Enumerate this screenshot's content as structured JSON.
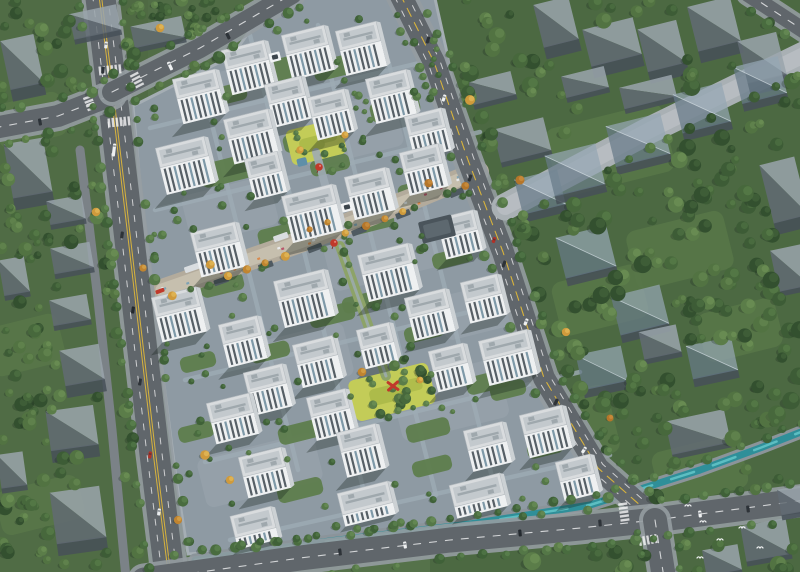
{
  "scene": {
    "description": "aerial-architectural-render-residential-masterplan",
    "canvas": {
      "width": 800,
      "height": 572
    },
    "palette": {
      "base_green": "#55724a",
      "left_tint": "#4d6842",
      "right_tint": "#43603a",
      "clearing": "#587748",
      "site_paving": "#8e9aa3",
      "site_paving_light": "#9aa6ae",
      "path": "#9eabb4",
      "courtyard": "#5e7d4d",
      "play_lawn": "#c3cc58",
      "play_lawn_dark": "#a8b647",
      "street_paving": "#b3ab9c",
      "street_paving_light": "#c6bfae",
      "sidewalk": "#959ca1",
      "asphalt": "#60666b",
      "asphalt_minor": "#7b8287",
      "lane_white": "#e8e9ea",
      "lane_yellow": "#d8b33c",
      "mall_paving": "#a9b0b4",
      "mall_paving_light": "#b8bec2",
      "canal_bank": "#8b949a",
      "water": "#2f8f99",
      "water_light": "#62c3c6",
      "roof_light": "#d9dcde",
      "roof_mid": "#c3c9cd",
      "roof_dark": "#9fa8ad",
      "facade": "#eef0f1",
      "facade_side": "#ccd1d4",
      "window_dark": "#565f66",
      "window_blue": "#7e99a8",
      "shadow": "rgba(22,32,28,0.33)",
      "ghost_light": "rgba(154,164,171,0.85)",
      "ghost_dark": "rgba(97,107,115,0.85)",
      "ghost_front": "rgba(70,80,88,0.85)",
      "glass_light": "rgba(148,166,179,0.72)",
      "glass_dark": "rgba(103,122,136,0.72)",
      "accent_red": "#c0392b",
      "shop_roof_dark": "#4f5a61",
      "canopy_white": "#d9dde0",
      "clubhouse": "#4a545b",
      "verge_green": "#7fb04c",
      "bird_white": "#f2f4f4"
    },
    "tree_palettes": {
      "forest": {
        "base": [
          "#33502f",
          "#3d5c36",
          "#47683c",
          "#527342",
          "#5b7d49"
        ],
        "hi": [
          "#4a6a40",
          "#557a48",
          "#60854e",
          "#6b9055",
          "#76995c"
        ]
      },
      "street": {
        "base": [
          "#3f6138",
          "#496c3f",
          "#547747"
        ],
        "hi": [
          "#5b8350",
          "#668e57",
          "#71985e"
        ]
      },
      "autumn": {
        "base": [
          "#c08430",
          "#cf9a3c",
          "#b5762a"
        ],
        "hi": [
          "#e2b659",
          "#edc968",
          "#d89c49"
        ]
      }
    }
  },
  "site": {
    "outline": [
      [
        133,
        106
      ],
      [
        232,
        56
      ],
      [
        276,
        -6
      ],
      [
        434,
        -6
      ],
      [
        446,
        48
      ],
      [
        466,
        158
      ],
      [
        498,
        252
      ],
      [
        538,
        385
      ],
      [
        592,
        472
      ],
      [
        612,
        502
      ],
      [
        520,
        512
      ],
      [
        380,
        536
      ],
      [
        240,
        550
      ],
      [
        188,
        554
      ],
      [
        176,
        478
      ],
      [
        157,
        330
      ],
      [
        141,
        195
      ]
    ],
    "paving_patches": [
      [
        250,
        90,
        90,
        50
      ],
      [
        350,
        130,
        100,
        55
      ],
      [
        230,
        210,
        90,
        50
      ],
      [
        380,
        250,
        110,
        60
      ],
      [
        300,
        360,
        100,
        55
      ],
      [
        450,
        400,
        110,
        60
      ],
      [
        260,
        470,
        120,
        50
      ],
      [
        480,
        310,
        80,
        45
      ]
    ]
  },
  "roads": [
    {
      "name": "road-main-left",
      "pts": [
        [
          100,
          -6
        ],
        [
          112,
          92
        ],
        [
          126,
          210
        ],
        [
          140,
          330
        ],
        [
          154,
          450
        ],
        [
          170,
          578
        ]
      ],
      "w": 30,
      "center": "yellow-double",
      "lanes": [
        -7.5,
        7.5
      ]
    },
    {
      "name": "road-left-branch",
      "pts": [
        [
          -6,
          128
        ],
        [
          58,
          116
        ],
        [
          112,
          95
        ]
      ],
      "w": 22,
      "center": "white-dash",
      "lanes": []
    },
    {
      "name": "road-top-arm",
      "pts": [
        [
          112,
          92
        ],
        [
          200,
          48
        ],
        [
          292,
          -6
        ]
      ],
      "w": 20,
      "center": "white-dash",
      "lanes": []
    },
    {
      "name": "road-right",
      "pts": [
        [
          400,
          -6
        ],
        [
          434,
          62
        ],
        [
          468,
          160
        ],
        [
          503,
          252
        ],
        [
          544,
          378
        ],
        [
          598,
          468
        ],
        [
          650,
          514
        ]
      ],
      "w": 22,
      "center": "yellow-dash",
      "lanes": [
        -6,
        6
      ]
    },
    {
      "name": "road-bottom",
      "pts": [
        [
          144,
          580
        ],
        [
          300,
          558
        ],
        [
          450,
          540
        ],
        [
          580,
          528
        ],
        [
          655,
          520
        ],
        [
          806,
          500
        ]
      ],
      "w": 25,
      "center": "white-dash",
      "lanes": []
    },
    {
      "name": "road-bottom-branch",
      "pts": [
        [
          655,
          520
        ],
        [
          664,
          578
        ]
      ],
      "w": 24,
      "center": "white-dash",
      "lanes": []
    },
    {
      "name": "road-corner-topright",
      "pts": [
        [
          748,
          -6
        ],
        [
          806,
          32
        ]
      ],
      "w": 16,
      "center": "white-dash",
      "lanes": []
    },
    {
      "name": "service-lane",
      "pts": [
        [
          80,
          150
        ],
        [
          98,
          300
        ],
        [
          112,
          430
        ],
        [
          126,
          578
        ]
      ],
      "w": 9,
      "center": "none",
      "lanes": [],
      "minor": true
    }
  ],
  "mall": {
    "pts": [
      [
        505,
        207
      ],
      [
        650,
        130
      ],
      [
        806,
        54
      ]
    ],
    "w": 27
  },
  "canal": {
    "pts": [
      [
        195,
        560
      ],
      [
        330,
        541
      ],
      [
        470,
        524
      ],
      [
        590,
        505
      ],
      [
        628,
        493
      ],
      [
        700,
        470
      ],
      [
        760,
        448
      ],
      [
        806,
        430
      ]
    ]
  },
  "commercial_street": {
    "pts": [
      [
        162,
        290
      ],
      [
        300,
        242
      ],
      [
        420,
        196
      ],
      [
        478,
        172
      ]
    ],
    "w": 22
  },
  "spines": {
    "upper": [
      [
        316,
        152
      ],
      [
        340,
        238
      ]
    ],
    "lower": [
      [
        340,
        246
      ],
      [
        386,
        376
      ]
    ]
  },
  "buildings": [
    [
      245,
      55,
      44,
      26
    ],
    [
      305,
      40,
      44,
      26
    ],
    [
      358,
      36,
      42,
      26
    ],
    [
      196,
      84,
      44,
      26
    ],
    [
      285,
      90,
      38,
      24
    ],
    [
      328,
      103,
      38,
      24
    ],
    [
      388,
      84,
      42,
      26
    ],
    [
      425,
      122,
      38,
      24
    ],
    [
      248,
      124,
      46,
      26
    ],
    [
      182,
      152,
      50,
      28
    ],
    [
      421,
      158,
      40,
      24
    ],
    [
      367,
      182,
      42,
      24
    ],
    [
      263,
      165,
      34,
      22
    ],
    [
      309,
      200,
      52,
      28
    ],
    [
      215,
      237,
      46,
      26
    ],
    [
      457,
      224,
      38,
      22
    ],
    [
      301,
      285,
      52,
      28
    ],
    [
      385,
      259,
      52,
      28
    ],
    [
      427,
      303,
      42,
      24
    ],
    [
      481,
      288,
      38,
      22
    ],
    [
      176,
      302,
      46,
      26
    ],
    [
      240,
      330,
      40,
      24
    ],
    [
      315,
      350,
      42,
      24
    ],
    [
      375,
      336,
      34,
      20
    ],
    [
      505,
      345,
      50,
      26
    ],
    [
      265,
      378,
      40,
      24
    ],
    [
      328,
      403,
      40,
      24
    ],
    [
      448,
      357,
      36,
      22
    ],
    [
      358,
      438,
      40,
      26
    ],
    [
      543,
      420,
      44,
      24
    ],
    [
      485,
      436,
      40,
      22
    ],
    [
      575,
      468,
      36,
      20
    ],
    [
      230,
      408,
      44,
      22
    ],
    [
      262,
      462,
      44,
      22
    ],
    [
      365,
      498,
      52,
      12
    ],
    [
      477,
      490,
      52,
      12
    ],
    [
      253,
      522,
      42,
      12
    ]
  ],
  "building_rotation": -14,
  "ghosts": [
    [
      22,
      62,
      34,
      50,
      -12,
      "t"
    ],
    [
      95,
      22,
      48,
      26,
      -12,
      "s"
    ],
    [
      158,
      32,
      52,
      22,
      -12,
      "s"
    ],
    [
      28,
      168,
      40,
      55,
      -10,
      "t"
    ],
    [
      66,
      210,
      36,
      24,
      -10,
      "s"
    ],
    [
      72,
      258,
      40,
      26,
      -10,
      "s"
    ],
    [
      14,
      276,
      26,
      36,
      -10,
      "s"
    ],
    [
      70,
      310,
      38,
      26,
      -10,
      "s"
    ],
    [
      82,
      365,
      40,
      36,
      -10,
      "t"
    ],
    [
      72,
      428,
      48,
      40,
      -8,
      "t"
    ],
    [
      78,
      515,
      50,
      52,
      -8,
      "t"
    ],
    [
      12,
      470,
      26,
      34,
      -8,
      "s"
    ],
    [
      556,
      22,
      36,
      44,
      -14,
      "t"
    ],
    [
      612,
      42,
      52,
      38,
      -14,
      "t"
    ],
    [
      662,
      46,
      40,
      44,
      -14,
      "t"
    ],
    [
      714,
      24,
      44,
      46,
      -14,
      "t"
    ],
    [
      762,
      58,
      40,
      44,
      -14,
      "t"
    ],
    [
      585,
      82,
      44,
      22,
      -14,
      "s"
    ],
    [
      648,
      92,
      54,
      22,
      -14,
      "s"
    ],
    [
      492,
      88,
      44,
      24,
      -14,
      "s"
    ],
    [
      522,
      140,
      52,
      34,
      -14,
      "s"
    ],
    [
      540,
      192,
      44,
      36,
      -14,
      "g"
    ],
    [
      575,
      170,
      52,
      42,
      -14,
      "g"
    ],
    [
      638,
      140,
      56,
      42,
      -14,
      "g"
    ],
    [
      702,
      108,
      50,
      40,
      -14,
      "g"
    ],
    [
      760,
      80,
      46,
      38,
      -14,
      "g"
    ],
    [
      784,
      190,
      36,
      60,
      -14,
      "t"
    ],
    [
      790,
      268,
      32,
      42,
      -12,
      "s"
    ],
    [
      586,
      252,
      52,
      42,
      -14,
      "g"
    ],
    [
      640,
      310,
      50,
      40,
      -14,
      "g"
    ],
    [
      602,
      368,
      46,
      36,
      -12,
      "g"
    ],
    [
      712,
      358,
      46,
      34,
      -12,
      "g"
    ],
    [
      660,
      342,
      38,
      28,
      -12,
      "s"
    ],
    [
      698,
      432,
      60,
      34,
      -12,
      "s"
    ],
    [
      766,
      540,
      46,
      36,
      -10,
      "s"
    ],
    [
      722,
      560,
      36,
      26,
      -10,
      "s"
    ],
    [
      794,
      500,
      30,
      26,
      -10,
      "s"
    ]
  ],
  "courtyards": [
    [
      270,
      72,
      60,
      22
    ],
    [
      340,
      66,
      54,
      20
    ],
    [
      225,
      95,
      44,
      18
    ],
    [
      395,
      108,
      50,
      20
    ],
    [
      230,
      170,
      60,
      24
    ],
    [
      305,
      140,
      44,
      18
    ],
    [
      330,
      165,
      40,
      16
    ],
    [
      420,
      190,
      44,
      18
    ],
    [
      282,
      235,
      48,
      20
    ],
    [
      372,
      222,
      44,
      18
    ],
    [
      452,
      258,
      40,
      16
    ],
    [
      222,
      285,
      44,
      18
    ],
    [
      332,
      315,
      46,
      18
    ],
    [
      424,
      332,
      40,
      16
    ],
    [
      270,
      352,
      40,
      16
    ],
    [
      488,
      382,
      44,
      18
    ],
    [
      300,
      432,
      44,
      18
    ],
    [
      428,
      430,
      44,
      18
    ],
    [
      508,
      390,
      36,
      16
    ],
    [
      300,
      490,
      46,
      18
    ],
    [
      432,
      466,
      40,
      16
    ],
    [
      198,
      362,
      36,
      16
    ],
    [
      196,
      432,
      36,
      16
    ],
    [
      545,
      448,
      36,
      16
    ],
    [
      362,
      302,
      40,
      16
    ]
  ],
  "play_lawns": [
    [
      316,
      142,
      56,
      36
    ],
    [
      392,
      392,
      82,
      42
    ],
    [
      224,
      264,
      30,
      20
    ]
  ],
  "clearings": [
    [
      610,
      150,
      120,
      70
    ],
    [
      680,
      250,
      100,
      60
    ],
    [
      600,
      300,
      90,
      55
    ],
    [
      560,
      430,
      110,
      70
    ],
    [
      700,
      470,
      90,
      55
    ],
    [
      740,
      330,
      80,
      50
    ],
    [
      30,
      120,
      70,
      45
    ],
    [
      25,
      345,
      75,
      50
    ],
    [
      40,
      505,
      85,
      45
    ]
  ],
  "inner_paths": [
    [
      [
        150,
        128
      ],
      [
        440,
        58
      ]
    ],
    [
      [
        155,
        210
      ],
      [
        480,
        132
      ]
    ],
    [
      [
        185,
        380
      ],
      [
        540,
        295
      ]
    ],
    [
      [
        205,
        462
      ],
      [
        580,
        372
      ]
    ],
    [
      [
        230,
        540
      ],
      [
        610,
        455
      ]
    ],
    [
      [
        250,
        35
      ],
      [
        366,
        500
      ]
    ],
    [
      [
        318,
        25
      ],
      [
        436,
        495
      ]
    ],
    [
      [
        388,
        60
      ],
      [
        492,
        477
      ]
    ],
    [
      [
        196,
        60
      ],
      [
        298,
        470
      ]
    ]
  ],
  "verges": [
    [
      494,
      212,
      32,
      5,
      69
    ],
    [
      516,
      290,
      32,
      5,
      70
    ],
    [
      540,
      356,
      32,
      5,
      72
    ]
  ],
  "tree_regions": [
    {
      "name": "left-belt",
      "rect": [
        0,
        0,
        140,
        572
      ],
      "count": 115,
      "rmin": 3.5,
      "rmax": 7.5,
      "pal": "forest"
    },
    {
      "name": "topleft-wedge",
      "rect": [
        118,
        0,
        170,
        92
      ],
      "count": 30,
      "rmin": 3.5,
      "rmax": 6.5,
      "pal": "forest"
    },
    {
      "name": "right-forest",
      "rect": [
        430,
        0,
        370,
        572
      ],
      "count": 210,
      "rmin": 4,
      "rmax": 9,
      "pal": "forest"
    },
    {
      "name": "site-interior",
      "rect": [
        150,
        0,
        450,
        550
      ],
      "count": 130,
      "rmin": 2.5,
      "rmax": 4.5,
      "pal": "street",
      "inside_site": true
    },
    {
      "name": "central-garden",
      "rect": [
        345,
        352,
        92,
        62
      ],
      "count": 22,
      "rmin": 3,
      "rmax": 5.5,
      "pal": "forest",
      "inside_site": true
    }
  ],
  "street_tree_spacing": 21,
  "canal_tree_spacing": 19,
  "autumn_trees": [
    [
      160,
      28
    ],
    [
      96,
      212
    ],
    [
      143,
      268
    ],
    [
      470,
      100
    ],
    [
      520,
      180
    ],
    [
      566,
      332
    ],
    [
      610,
      418
    ],
    [
      205,
      455
    ],
    [
      230,
      480
    ],
    [
      178,
      520
    ],
    [
      362,
      372
    ],
    [
      420,
      380
    ],
    [
      300,
      150
    ],
    [
      345,
      135
    ]
  ],
  "shops": {
    "count": 14,
    "stall_count": 30,
    "stall_colors": [
      "#e8eaec",
      "#d98a4e",
      "#b9556b",
      "#7fa3b5"
    ]
  },
  "accents": {
    "balloons": [
      [
        319,
        167
      ],
      [
        334,
        243
      ]
    ],
    "ribbon_sculpture": [
      393,
      386
    ],
    "red_canopy": [
      160,
      291
    ],
    "gates": [
      [
        275,
        57
      ],
      [
        347,
        207
      ]
    ],
    "pool": [
      302,
      162
    ],
    "clubhouse": [
      437,
      229
    ]
  },
  "cars": [
    [
      106,
      45,
      6,
      "#e9ecee",
      7
    ],
    [
      103,
      70,
      6,
      "#2e3338",
      7
    ],
    [
      114,
      150,
      7,
      "#eef0f1",
      13
    ],
    [
      122,
      235,
      7,
      "#2e3338",
      7
    ],
    [
      133,
      310,
      8,
      "#23282d",
      7
    ],
    [
      140,
      382,
      8,
      "#2e3338",
      7
    ],
    [
      150,
      455,
      8,
      "#b23127",
      7
    ],
    [
      159,
      512,
      8,
      "#e9ecee",
      7
    ],
    [
      428,
      40,
      18,
      "#2e3338",
      7
    ],
    [
      444,
      98,
      19,
      "#eef0f1",
      7
    ],
    [
      470,
      178,
      20,
      "#2e3338",
      7
    ],
    [
      494,
      240,
      21,
      "#b23127",
      6
    ],
    [
      504,
      264,
      21,
      "#2e3338",
      7
    ],
    [
      526,
      322,
      23,
      "#eef0f1",
      7
    ],
    [
      556,
      402,
      27,
      "#2e3338",
      7
    ],
    [
      584,
      450,
      33,
      "#eef0f1",
      7
    ],
    [
      340,
      552,
      -8,
      "#2e3338",
      7
    ],
    [
      405,
      545,
      -8,
      "#eef0f1",
      7
    ],
    [
      520,
      533,
      -6,
      "#23282d",
      7
    ],
    [
      600,
      523,
      -5,
      "#2e3338",
      7
    ],
    [
      700,
      514,
      -7,
      "#eef0f1",
      7
    ],
    [
      748,
      509,
      -7,
      "#2e3338",
      7
    ],
    [
      170,
      66,
      -26,
      "#eef0f1",
      9
    ],
    [
      228,
      36,
      -26,
      "#2e3338",
      7
    ],
    [
      40,
      122,
      -10,
      "#2e3338",
      7
    ]
  ],
  "crosswalks": [
    [
      109,
      70,
      84,
      26
    ],
    [
      118,
      122,
      84,
      26
    ],
    [
      90,
      104,
      -21,
      18
    ],
    [
      137,
      80,
      -27,
      16
    ],
    [
      624,
      513,
      -8,
      22
    ],
    [
      648,
      540,
      80,
      20
    ]
  ],
  "birds": [
    [
      703,
      522
    ],
    [
      720,
      540
    ],
    [
      742,
      528
    ],
    [
      700,
      558
    ],
    [
      760,
      548
    ],
    [
      688,
      506
    ]
  ]
}
